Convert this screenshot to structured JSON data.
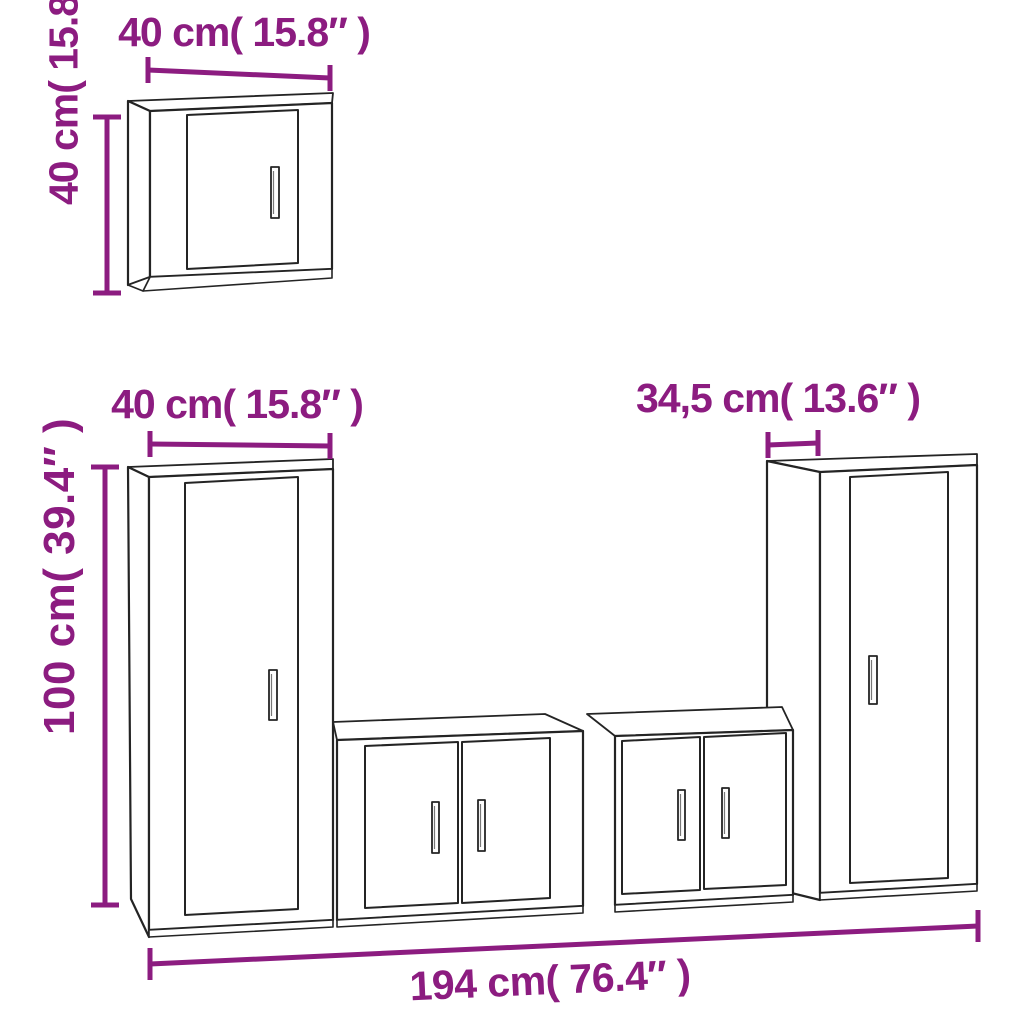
{
  "page": {
    "background": "#ffffff"
  },
  "diagram": {
    "accent_color": "#8C1C80",
    "line_color": "#242424",
    "dimensions": {
      "wall_cabinet_width": "40 cm( 15.8″ )",
      "wall_cabinet_height": "40 cm( 15.8″ )",
      "tall_cabinet_width": "40 cm( 15.8″ )",
      "tall_cabinet_height": "100 cm( 39.4″ )",
      "right_cabinet_depth": "34,5 cm( 13.6″ )",
      "total_width": "194 cm( 76.4″ )"
    }
  }
}
